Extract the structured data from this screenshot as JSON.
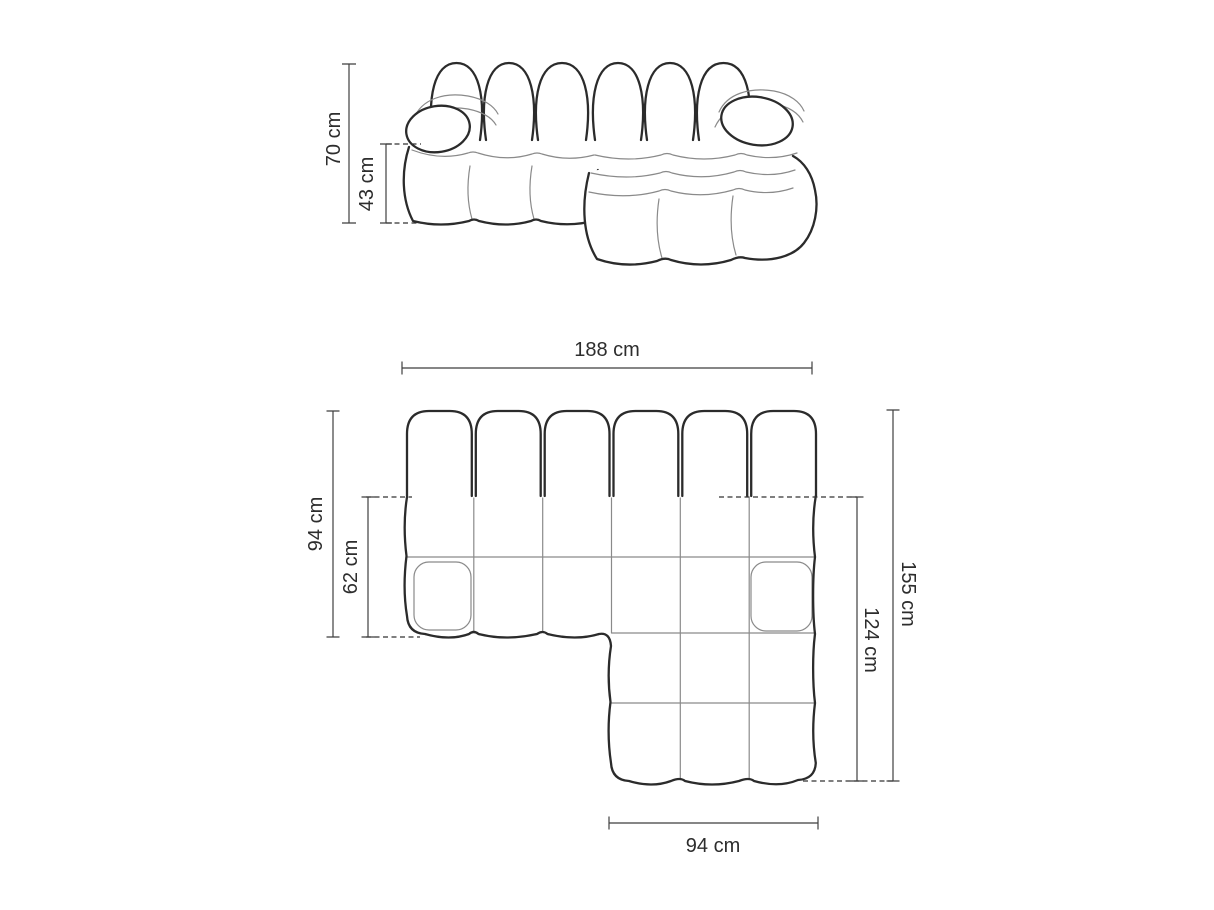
{
  "canvas": {
    "width": 1214,
    "height": 910,
    "background": "#ffffff"
  },
  "diagram": {
    "subject": "Modular chaise sofa dimension drawing",
    "colors": {
      "outline": "#2b2b2b",
      "seam": "#8a8a8a",
      "dimension_line": "#3f3f3f",
      "text": "#2d2d2d",
      "fill": "#ffffff"
    },
    "front_view": {
      "dims": {
        "height": {
          "label": "70 cm",
          "value": 70,
          "unit": "cm"
        },
        "seat_height": {
          "label": "43 cm",
          "value": 43,
          "unit": "cm"
        }
      }
    },
    "top_view": {
      "dims": {
        "overall_width": {
          "label": "188 cm",
          "value": 188,
          "unit": "cm"
        },
        "body_depth": {
          "label": "94 cm",
          "value": 94,
          "unit": "cm"
        },
        "seat_depth": {
          "label": "62 cm",
          "value": 62,
          "unit": "cm"
        },
        "overall_depth": {
          "label": "155 cm",
          "value": 155,
          "unit": "cm"
        },
        "chaise_depth": {
          "label": "124 cm",
          "value": 124,
          "unit": "cm"
        },
        "chaise_width": {
          "label": "94 cm",
          "value": 94,
          "unit": "cm"
        }
      }
    }
  }
}
